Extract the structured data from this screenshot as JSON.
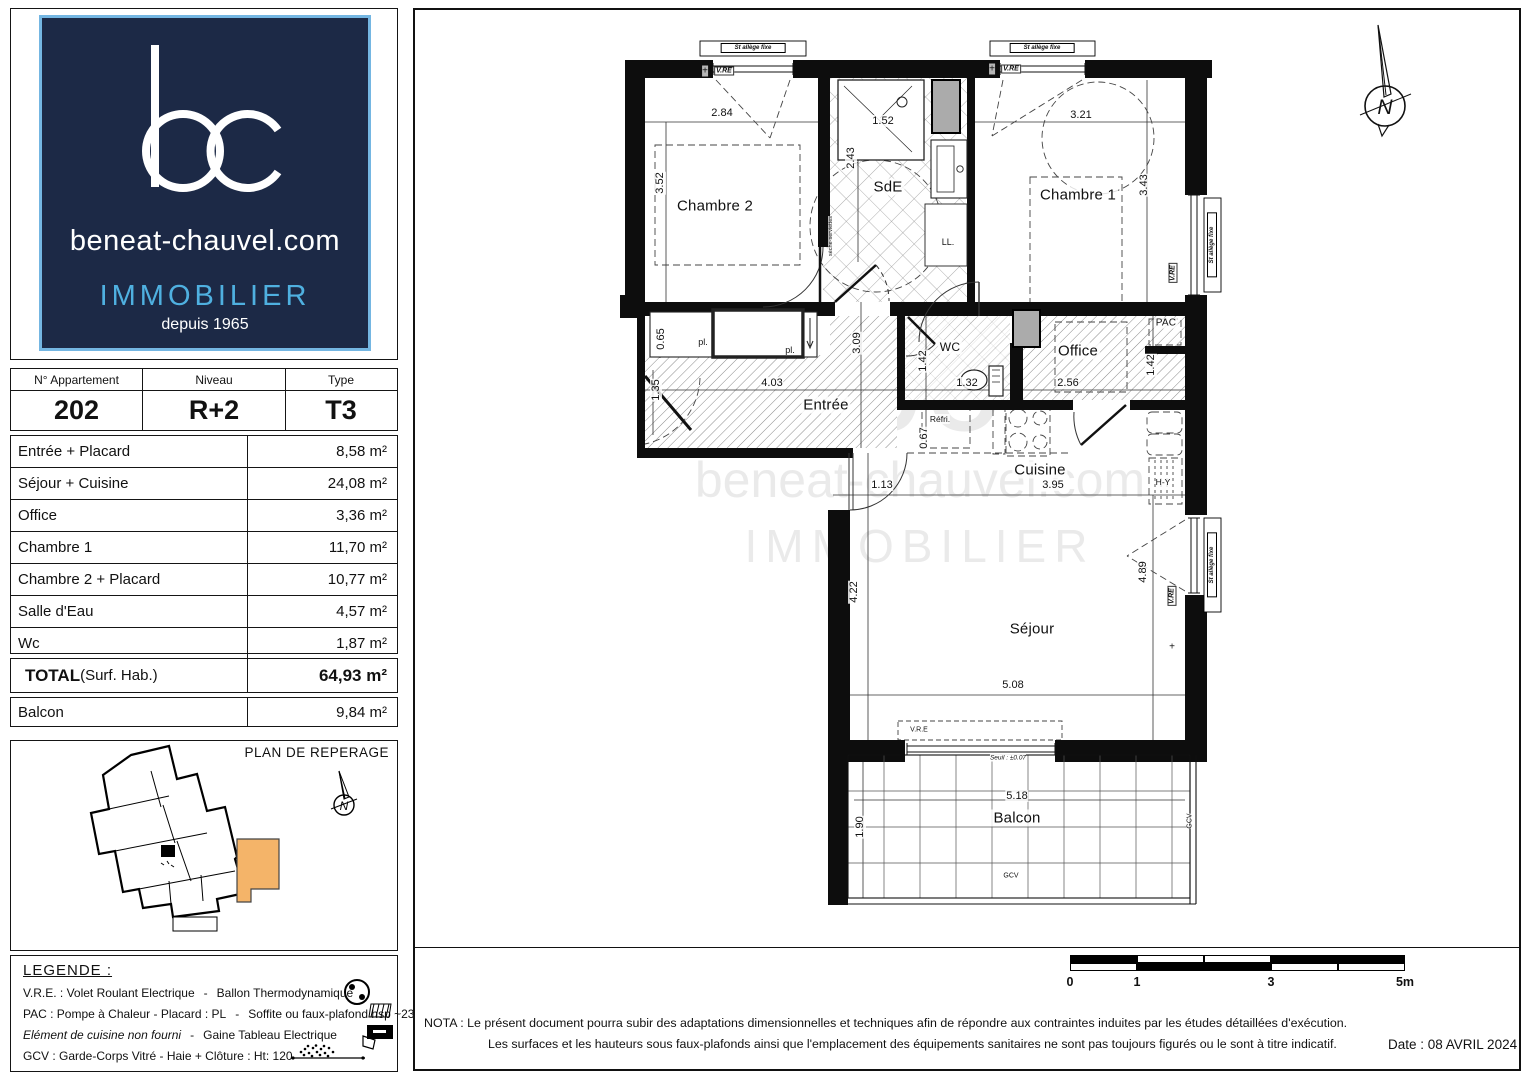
{
  "branding": {
    "monogram": "bc",
    "domain": "beneat-chauvel.com",
    "sector": "IMMOBILIER",
    "since": "depuis 1965"
  },
  "unit_info": {
    "headers": [
      "N° Appartement",
      "Niveau",
      "Type"
    ],
    "values": [
      "202",
      "R+2",
      "T3"
    ]
  },
  "areas": {
    "rows": [
      {
        "label": "Entrée + Placard",
        "value": "8,58 m²"
      },
      {
        "label": "Séjour + Cuisine",
        "value": "24,08 m²"
      },
      {
        "label": "Office",
        "value": "3,36 m²"
      },
      {
        "label": "Chambre 1",
        "value": "11,70 m²"
      },
      {
        "label": "Chambre 2 + Placard",
        "value": "10,77 m²"
      },
      {
        "label": "Salle d'Eau",
        "value": "4,57 m²"
      },
      {
        "label": "Wc",
        "value": "1,87 m²"
      }
    ],
    "total_label": "TOTAL",
    "total_suffix": " (Surf. Hab.)",
    "total_value": "64,93 m²",
    "balcony_label": "Balcon",
    "balcony_value": "9,84 m²"
  },
  "reperage": {
    "title": "PLAN DE REPERAGE"
  },
  "legend": {
    "title": "LEGENDE :",
    "rows": [
      {
        "left": "V.R.E. :  Volet Roulant Electrique",
        "right": "Ballon Thermodynamique",
        "italic": false
      },
      {
        "left": "PAC : Pompe à Chaleur  -  Placard :  PL",
        "right": "Soffite ou faux-plafond hsp ~230",
        "italic": false
      },
      {
        "left": "Elément de cuisine non fourni",
        "right": "Gaine Tableau Electrique",
        "italic": true
      },
      {
        "left": "GCV : Garde-Corps Vitré  -  Haie + Clôture : Ht: 120",
        "right": "",
        "italic": false
      }
    ]
  },
  "compass": {
    "letter": "N"
  },
  "watermark": {
    "line1": "bc",
    "line2": "beneat-chauvel.com",
    "line3": "IMMOBILIER"
  },
  "plan": {
    "labels": [
      {
        "t": "Chambre 2",
        "x": 95,
        "y": 166,
        "s": 15,
        "c": "room"
      },
      {
        "t": "SdE",
        "x": 268,
        "y": 147,
        "s": 15,
        "c": "room"
      },
      {
        "t": "Chambre 1",
        "x": 458,
        "y": 155,
        "s": 15,
        "c": "room"
      },
      {
        "t": "Entrée",
        "x": 206,
        "y": 365,
        "s": 15,
        "c": "room"
      },
      {
        "t": "WC",
        "x": 330,
        "y": 307,
        "s": 12,
        "c": "room"
      },
      {
        "t": "Office",
        "x": 458,
        "y": 311,
        "s": 15,
        "c": "room"
      },
      {
        "t": "PAC",
        "x": 546,
        "y": 283,
        "s": 10,
        "c": "room"
      },
      {
        "t": "Cuisine",
        "x": 420,
        "y": 430,
        "s": 15,
        "c": "room"
      },
      {
        "t": "Séjour",
        "x": 412,
        "y": 589,
        "s": 15,
        "c": "room"
      },
      {
        "t": "Balcon",
        "x": 397,
        "y": 778,
        "s": 15,
        "c": "room"
      },
      {
        "t": "Réfri.",
        "x": 320,
        "y": 379,
        "s": 8.5,
        "c": "small"
      },
      {
        "t": "LL.",
        "x": 328,
        "y": 202,
        "s": 9,
        "c": "small"
      },
      {
        "t": "H-Y",
        "x": 543,
        "y": 442,
        "s": 8.5,
        "c": "small"
      },
      {
        "t": "pl.",
        "x": 83,
        "y": 302,
        "s": 9,
        "c": "small"
      },
      {
        "t": "pl.",
        "x": 170,
        "y": 310,
        "s": 9,
        "c": "small"
      },
      {
        "t": "2.84",
        "x": 102,
        "y": 73,
        "s": 11,
        "c": "dim"
      },
      {
        "t": "3.52",
        "x": 40,
        "y": 143,
        "s": 11,
        "r": 1,
        "c": "dim"
      },
      {
        "t": "1.52",
        "x": 263,
        "y": 81,
        "s": 11,
        "c": "dim"
      },
      {
        "t": "2.43",
        "x": 231,
        "y": 118,
        "s": 11,
        "r": 1,
        "c": "dim"
      },
      {
        "t": "3.21",
        "x": 461,
        "y": 75,
        "s": 11,
        "c": "dim"
      },
      {
        "t": "3.43",
        "x": 524,
        "y": 145,
        "s": 11,
        "r": 1,
        "c": "dim"
      },
      {
        "t": "0.65",
        "x": 41,
        "y": 299,
        "s": 11,
        "r": 1,
        "c": "dim"
      },
      {
        "t": "3.09",
        "x": 237,
        "y": 303,
        "s": 11,
        "r": 1,
        "c": "dim"
      },
      {
        "t": "4.03",
        "x": 152,
        "y": 343,
        "s": 11,
        "c": "dim"
      },
      {
        "t": "1.35",
        "x": 36,
        "y": 350,
        "s": 11,
        "r": 1,
        "c": "dim"
      },
      {
        "t": "1.42",
        "x": 303,
        "y": 321,
        "s": 11,
        "r": 1,
        "c": "dim"
      },
      {
        "t": "1.32",
        "x": 347,
        "y": 343,
        "s": 11,
        "c": "dim"
      },
      {
        "t": "2.56",
        "x": 448,
        "y": 343,
        "s": 11,
        "c": "dim"
      },
      {
        "t": "1.42",
        "x": 531,
        "y": 325,
        "s": 11,
        "r": 1,
        "c": "dim"
      },
      {
        "t": "0.67",
        "x": 304,
        "y": 398,
        "s": 11,
        "r": 1,
        "c": "dim"
      },
      {
        "t": "1.13",
        "x": 262,
        "y": 445,
        "s": 11,
        "c": "dim"
      },
      {
        "t": "3.95",
        "x": 433,
        "y": 445,
        "s": 11,
        "c": "dim"
      },
      {
        "t": "4.22",
        "x": 234,
        "y": 552,
        "s": 11,
        "r": 1,
        "c": "dim"
      },
      {
        "t": "4.89",
        "x": 523,
        "y": 532,
        "s": 11,
        "r": 1,
        "c": "dim"
      },
      {
        "t": "5.08",
        "x": 393,
        "y": 645,
        "s": 11,
        "c": "dim"
      },
      {
        "t": "5.18",
        "x": 397,
        "y": 756,
        "s": 11,
        "c": "dim"
      },
      {
        "t": "1.90",
        "x": 240,
        "y": 787,
        "s": 11,
        "r": 1,
        "c": "dim"
      },
      {
        "t": "V.RE",
        "x": 104,
        "y": 31,
        "s": 7,
        "c": "vre"
      },
      {
        "t": "V.RE",
        "x": 391,
        "y": 29,
        "s": 7,
        "c": "vre"
      },
      {
        "t": "V.RE",
        "x": 553,
        "y": 233,
        "s": 7,
        "r": 1,
        "c": "vre"
      },
      {
        "t": "V.RE",
        "x": 552,
        "y": 556,
        "s": 7,
        "r": 1,
        "c": "vre"
      },
      {
        "t": "V.R.E",
        "x": 299,
        "y": 690,
        "s": 7,
        "c": "annot"
      },
      {
        "t": "Seuil : ±0.07",
        "x": 388,
        "y": 718,
        "s": 6.5,
        "c": "annot-i"
      },
      {
        "t": "GCV",
        "x": 391,
        "y": 836,
        "s": 7,
        "c": "annot"
      },
      {
        "t": "GCV",
        "x": 570,
        "y": 781,
        "s": 7,
        "r": 1,
        "c": "annot"
      },
      {
        "t": "sèche-serviettes",
        "x": 211,
        "y": 196,
        "s": 5.5,
        "r": 1,
        "c": "annot"
      },
      {
        "t": "St allège fixe",
        "x": 133,
        "y": 8,
        "s": 6,
        "c": "sill"
      },
      {
        "t": "St allège fixe",
        "x": 422,
        "y": 8,
        "s": 6,
        "c": "sill"
      },
      {
        "t": "St allège fixe",
        "x": 592,
        "y": 205,
        "s": 6,
        "r": 1,
        "c": "sill"
      },
      {
        "t": "St allège fixe",
        "x": 592,
        "y": 525,
        "s": 6,
        "r": 1,
        "c": "sill"
      },
      {
        "t": "+",
        "x": 85,
        "y": 31,
        "s": 10,
        "c": "annot"
      },
      {
        "t": "+",
        "x": 372,
        "y": 29,
        "s": 10,
        "c": "annot"
      },
      {
        "t": "+",
        "x": 552,
        "y": 607,
        "s": 10,
        "c": "annot"
      }
    ]
  },
  "footer": {
    "scale_ticks": [
      "0",
      "1",
      "3",
      "5m"
    ],
    "nota_line1": "NOTA :  Le présent document pourra subir des adaptations dimensionnelles et techniques afin de répondre aux contraintes induites par les études détaillées d'exécution.",
    "nota_line2": "Les surfaces et les hauteurs sous faux-plafonds ainsi que l'emplacement des équipements sanitaires ne sont pas toujours figurés ou le sont à titre indicatif.",
    "date": "Date : 08 AVRIL 2024"
  }
}
